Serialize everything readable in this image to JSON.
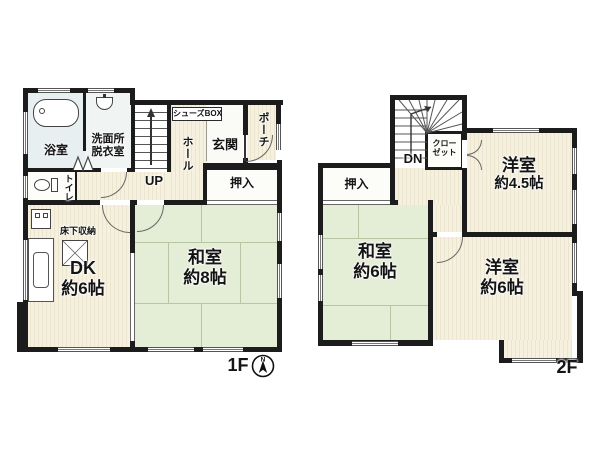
{
  "floor1": {
    "label": "1F",
    "bath": "浴室",
    "washroom1": "洗面所",
    "washroom2": "脱衣室",
    "shoes_box": "シューズBOX",
    "hall": "ホール",
    "entrance": "玄関",
    "porch": "ポーチ",
    "stairs_dir": "UP",
    "oshiire": "押入",
    "toilet": "トイレ",
    "underfloor": "床下収納",
    "dk1": "DK",
    "dk2": "約6帖",
    "washitsu1": "和室",
    "washitsu2": "約8帖"
  },
  "floor2": {
    "label": "2F",
    "stairs_dir": "DN",
    "closet1": "クロー",
    "closet2": "ゼット",
    "oshiire": "押入",
    "yoshitsu45_1": "洋室",
    "yoshitsu45_2": "約4.5帖",
    "washitsu1": "和室",
    "washitsu2": "約6帖",
    "yoshitsu6_1": "洋室",
    "yoshitsu6_2": "約6帖"
  },
  "compass_n": "N",
  "colors": {
    "wall": "#1c1c1c",
    "floor": "#f6f0df",
    "tatami": "#e4edd6",
    "bath": "#e8eff1"
  }
}
